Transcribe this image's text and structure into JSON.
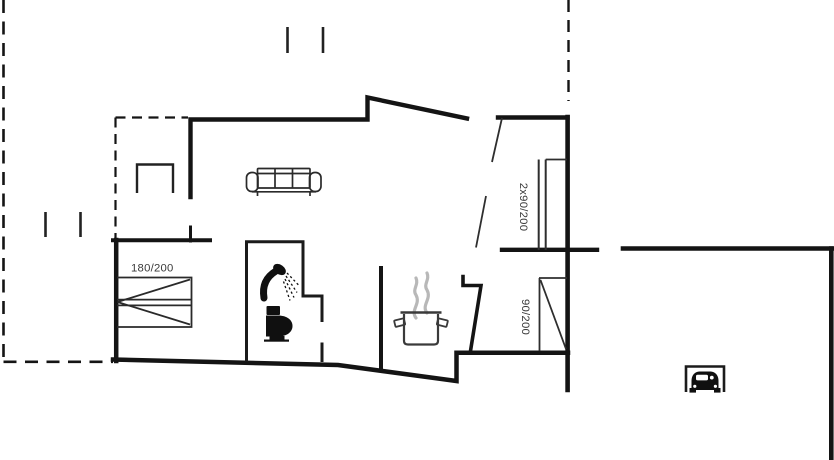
{
  "floorplan": {
    "labels": {
      "bed_size": "180/200",
      "entrance_double_door_size": "2x90/200",
      "interior_door_size": "90/200"
    },
    "colors": {
      "wall": "#141414",
      "medium_line": "#222222",
      "thin_line": "#2e2e2e",
      "icon_black": "#101010",
      "steam_gray": "#b8b8b8",
      "label_text": "#3a3a3a",
      "background": "#ffffff"
    },
    "icons": {
      "sofa": "sofa-icon",
      "bed": "double-bed-icon",
      "table": "table-icon",
      "shower": "shower-icon",
      "toilet": "toilet-icon",
      "cooking_pot": "cooking-pot-icon",
      "steam": "steam-icon",
      "car_carport": "car-carport-icon"
    }
  }
}
